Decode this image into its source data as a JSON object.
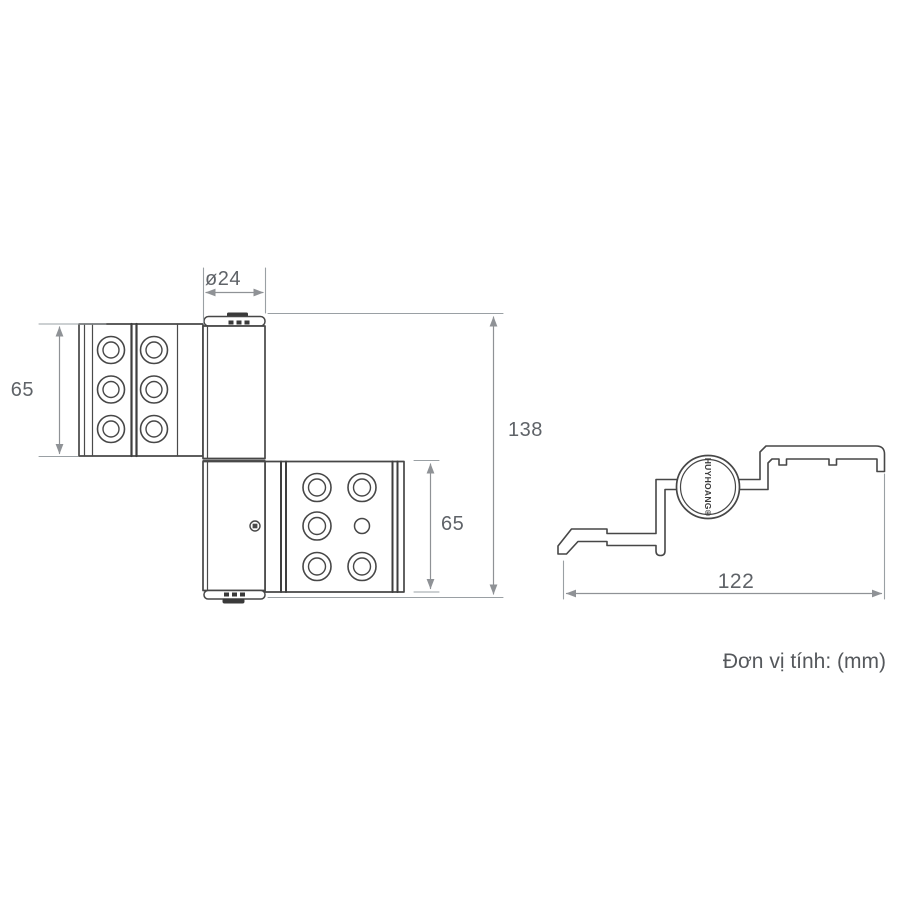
{
  "drawing": {
    "unit_note": "Đơn vị tính: (mm)",
    "brand_mark": "HUYHOANG®",
    "views": {
      "front": {
        "name": "hinge-front-view",
        "dimensions": {
          "barrel_diameter": "ø24",
          "upper_leaf_height": "65",
          "overall_height": "138",
          "lower_leaf_height": "65"
        },
        "features": {
          "upper_leaf_holes": 6,
          "lower_leaf_large_holes": 5,
          "lower_leaf_small_holes": 1
        }
      },
      "profile": {
        "name": "hinge-profile-section-view",
        "dimensions": {
          "overall_width": "122"
        }
      }
    },
    "colors": {
      "outline": "#474747",
      "dimension_line": "#8f9296",
      "dimension_text": "#5f6368",
      "background": "#ffffff"
    }
  }
}
